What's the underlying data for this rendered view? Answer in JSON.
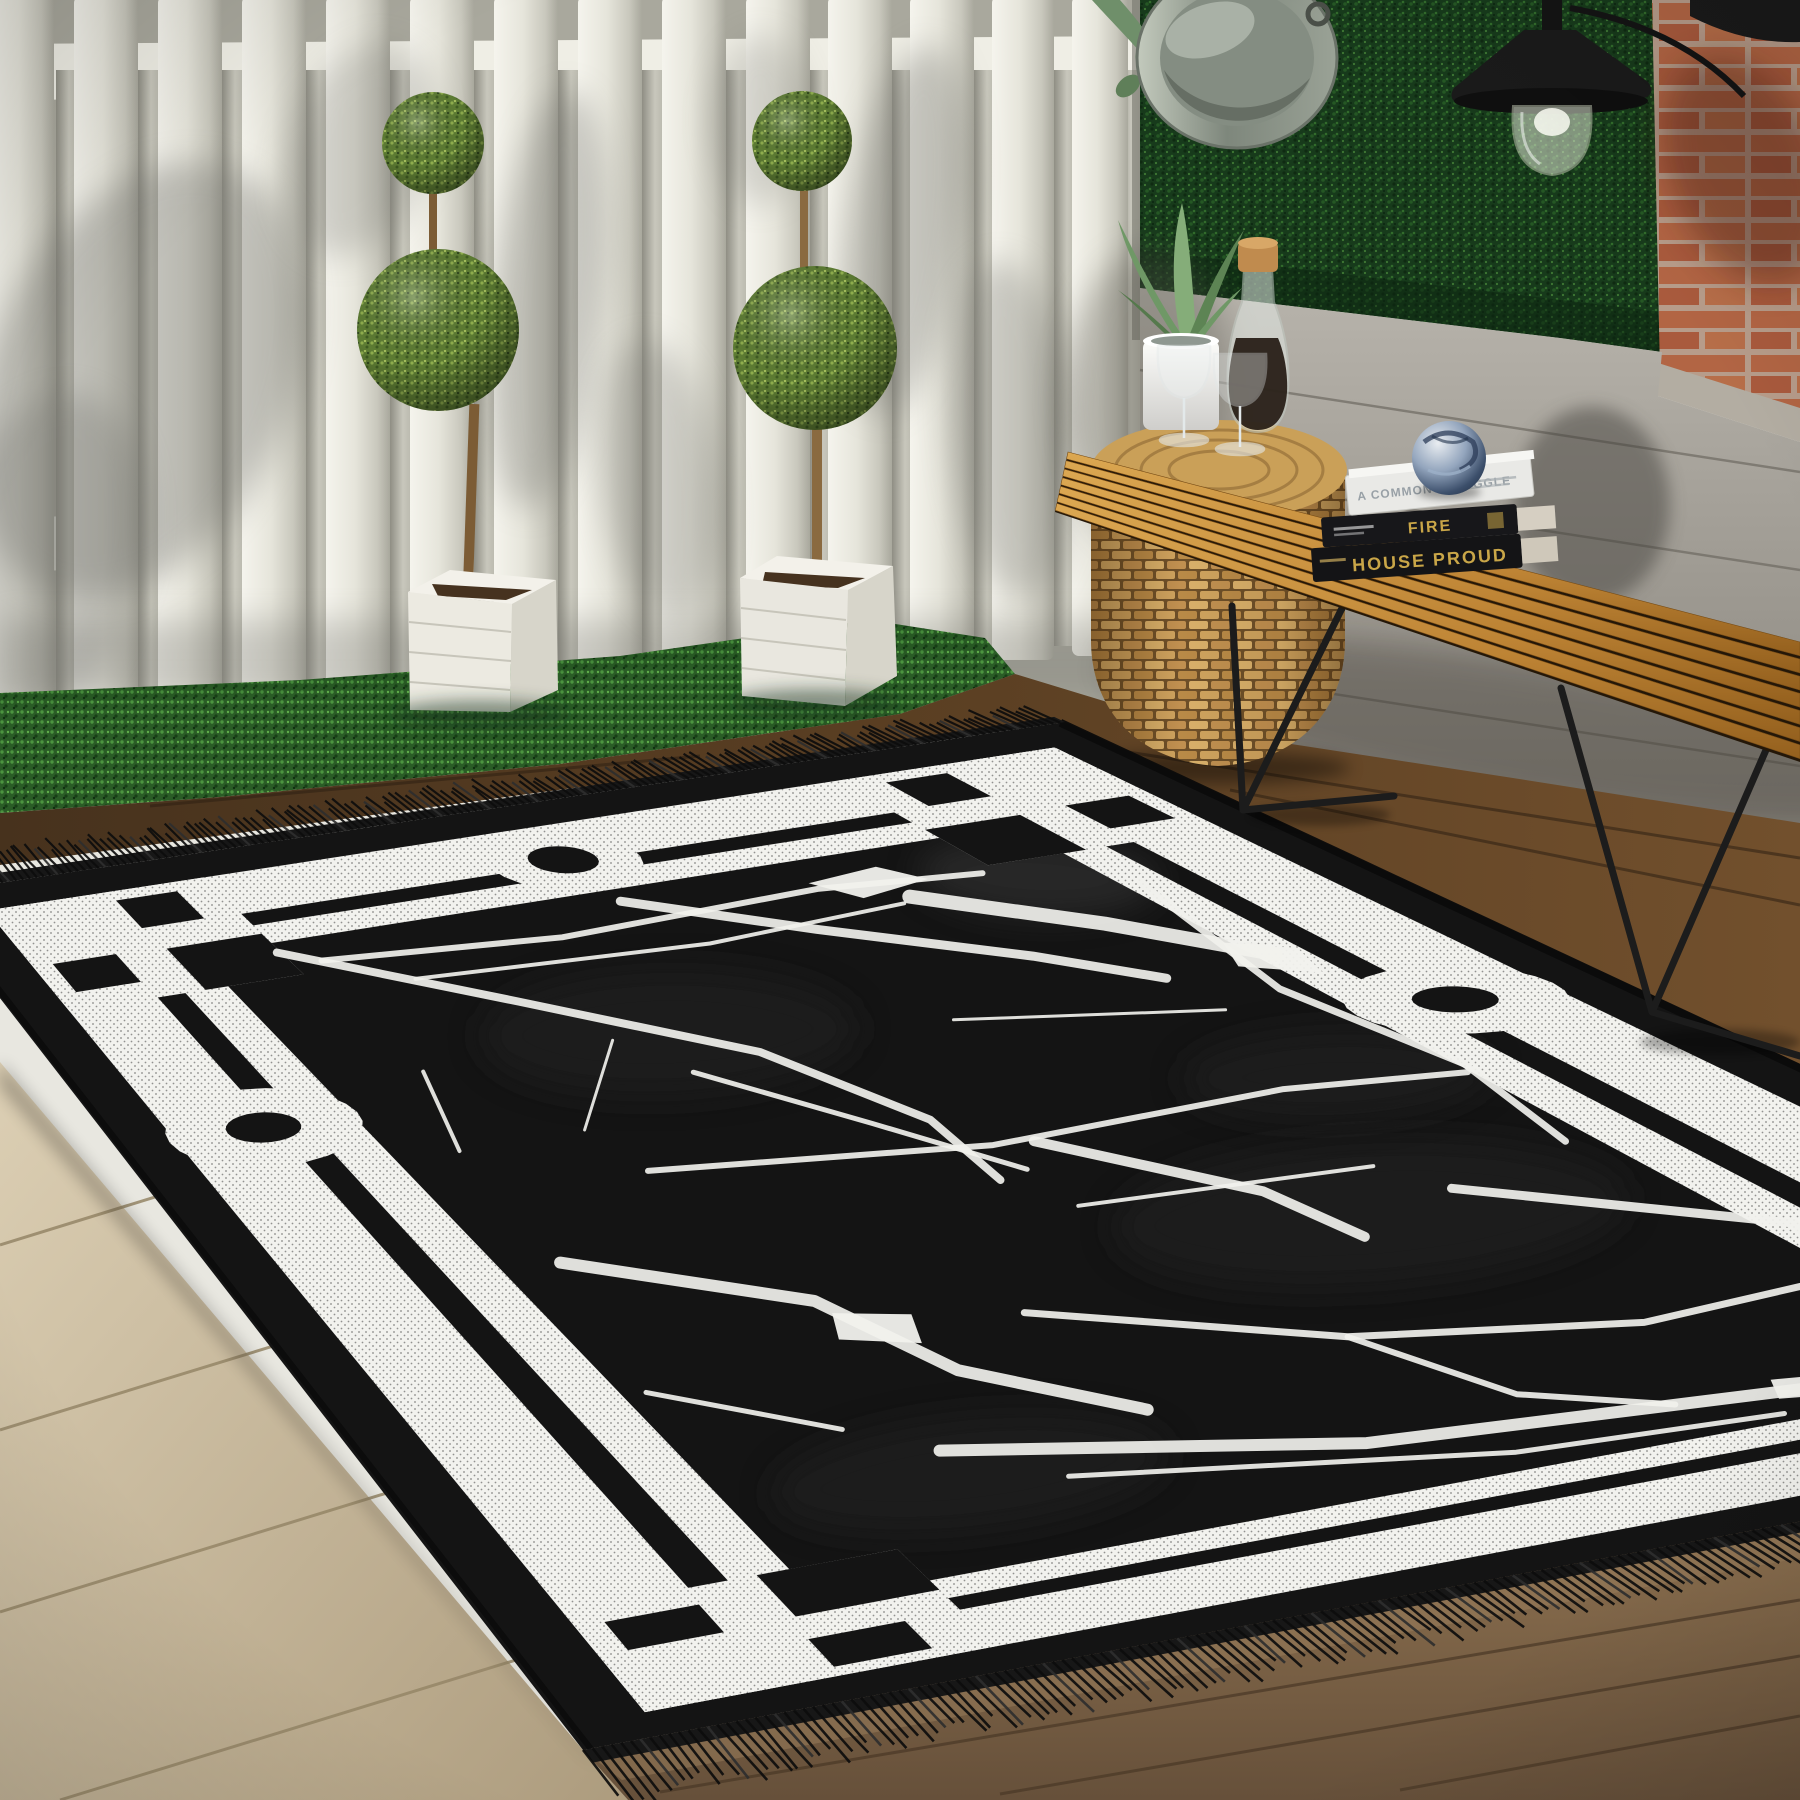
{
  "photo": {
    "kind": "outdoor-patio-product-photo",
    "subject": "black and white marble pattern area rug with greek-key border"
  },
  "books": [
    {
      "title": "A COMMON STRUGGLE"
    },
    {
      "title": "FIRE"
    },
    {
      "title": "HOUSE PROUD"
    }
  ],
  "palette": {
    "rug_black": "#141414",
    "rug_white": "#f1f1ed",
    "rug_fringe": "#0d0d0d",
    "fence_white": "#efeee6",
    "fence_shadow": "#70706a",
    "hedge_green": "#1d4420",
    "grass_green": "#2a5c26",
    "brick_orange": "#bd6f4c",
    "mortar": "#c4b3a1",
    "plank_gray": "#a19d95",
    "bench_wood": "#c08a3c",
    "wicker_tan": "#d9b06a",
    "floor_light": "#cdbfa4",
    "floor_dark": "#6e4c2a",
    "book_gold": "#c9a648",
    "sphere_blue": "#3c4f6b",
    "metal_gray": "#99a195"
  }
}
